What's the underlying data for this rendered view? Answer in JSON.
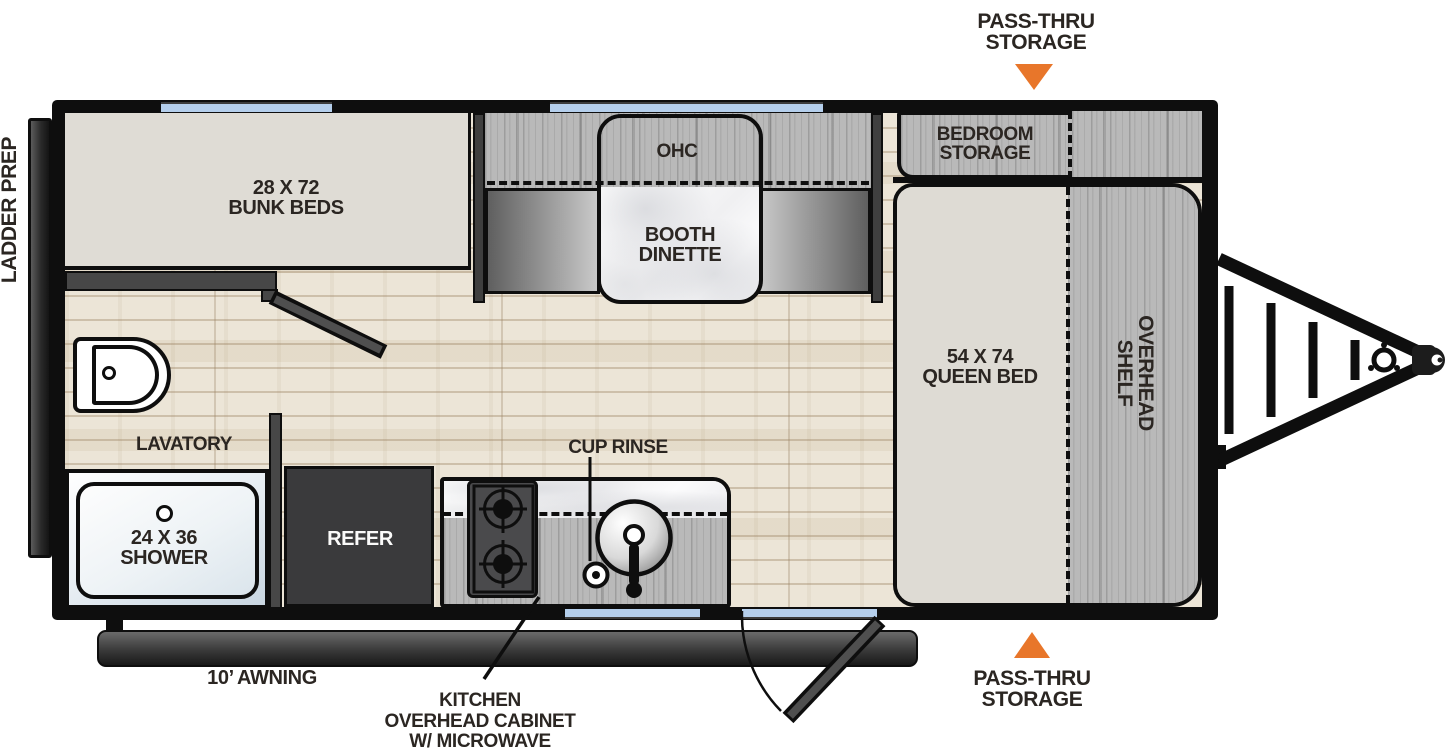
{
  "colors": {
    "accent_orange": "#E8762A",
    "wall_black": "#0E0E0E",
    "window_blue": "#B5CFEC",
    "floor_wood": "#ECE5D7",
    "cabinet_gray": "#B9B9B9",
    "bed_beige": "#DEDBD4",
    "refer_dark": "#3A3A3C",
    "label_ink": "#2B2622"
  },
  "callouts": {
    "pass_thru_top": {
      "line1": "PASS-THRU",
      "line2": "STORAGE"
    },
    "pass_thru_bottom": {
      "line1": "PASS-THRU",
      "line2": "STORAGE"
    },
    "ladder_prep": "LADDER PREP",
    "awning": "10’ AWNING",
    "kitchen_cabinet": {
      "line1": "KITCHEN",
      "line2": "OVERHEAD CABINET",
      "line3": "W/ MICROWAVE"
    },
    "cup_rinse": "CUP RINSE"
  },
  "rooms": {
    "bunk_beds": {
      "line1": "28 X 72",
      "line2": "BUNK BEDS"
    },
    "overhead_cabinet": "OHC",
    "booth_dinette": {
      "line1": "BOOTH",
      "line2": "DINETTE"
    },
    "bedroom_storage": {
      "line1": "BEDROOM",
      "line2": "STORAGE"
    },
    "queen_bed": {
      "line1": "54 X 74",
      "line2": "QUEEN BED"
    },
    "overhead_shelf": {
      "line1": "OVERHEAD",
      "line2": "SHELF"
    },
    "lavatory": "LAVATORY",
    "shower": {
      "line1": "24 X 36",
      "line2": "SHOWER"
    },
    "refrigerator": "REFER"
  }
}
